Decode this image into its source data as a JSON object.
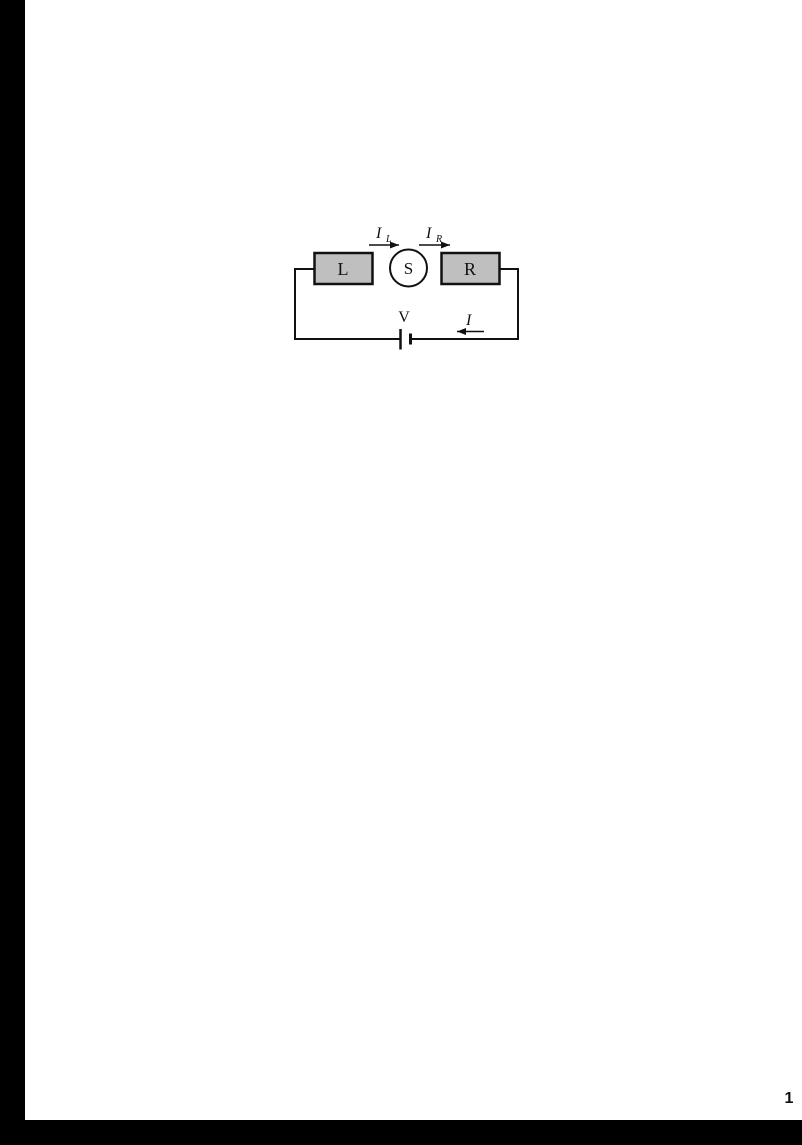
{
  "page": {
    "number": "1",
    "background": "#ffffff",
    "edge_bar_color": "#000000"
  },
  "circuit": {
    "left_lead": {
      "label": "L"
    },
    "sample": {
      "label": "S"
    },
    "right_lead": {
      "label": "R"
    },
    "battery": {
      "label": "V"
    },
    "current_left": {
      "symbol": "I",
      "subscript": "L"
    },
    "current_right": {
      "symbol": "I",
      "subscript": "R"
    },
    "current_main": {
      "symbol": "I"
    },
    "colors": {
      "lead_fill": "#bfbfbf",
      "sample_fill": "#ffffff",
      "line": "#000000"
    }
  }
}
